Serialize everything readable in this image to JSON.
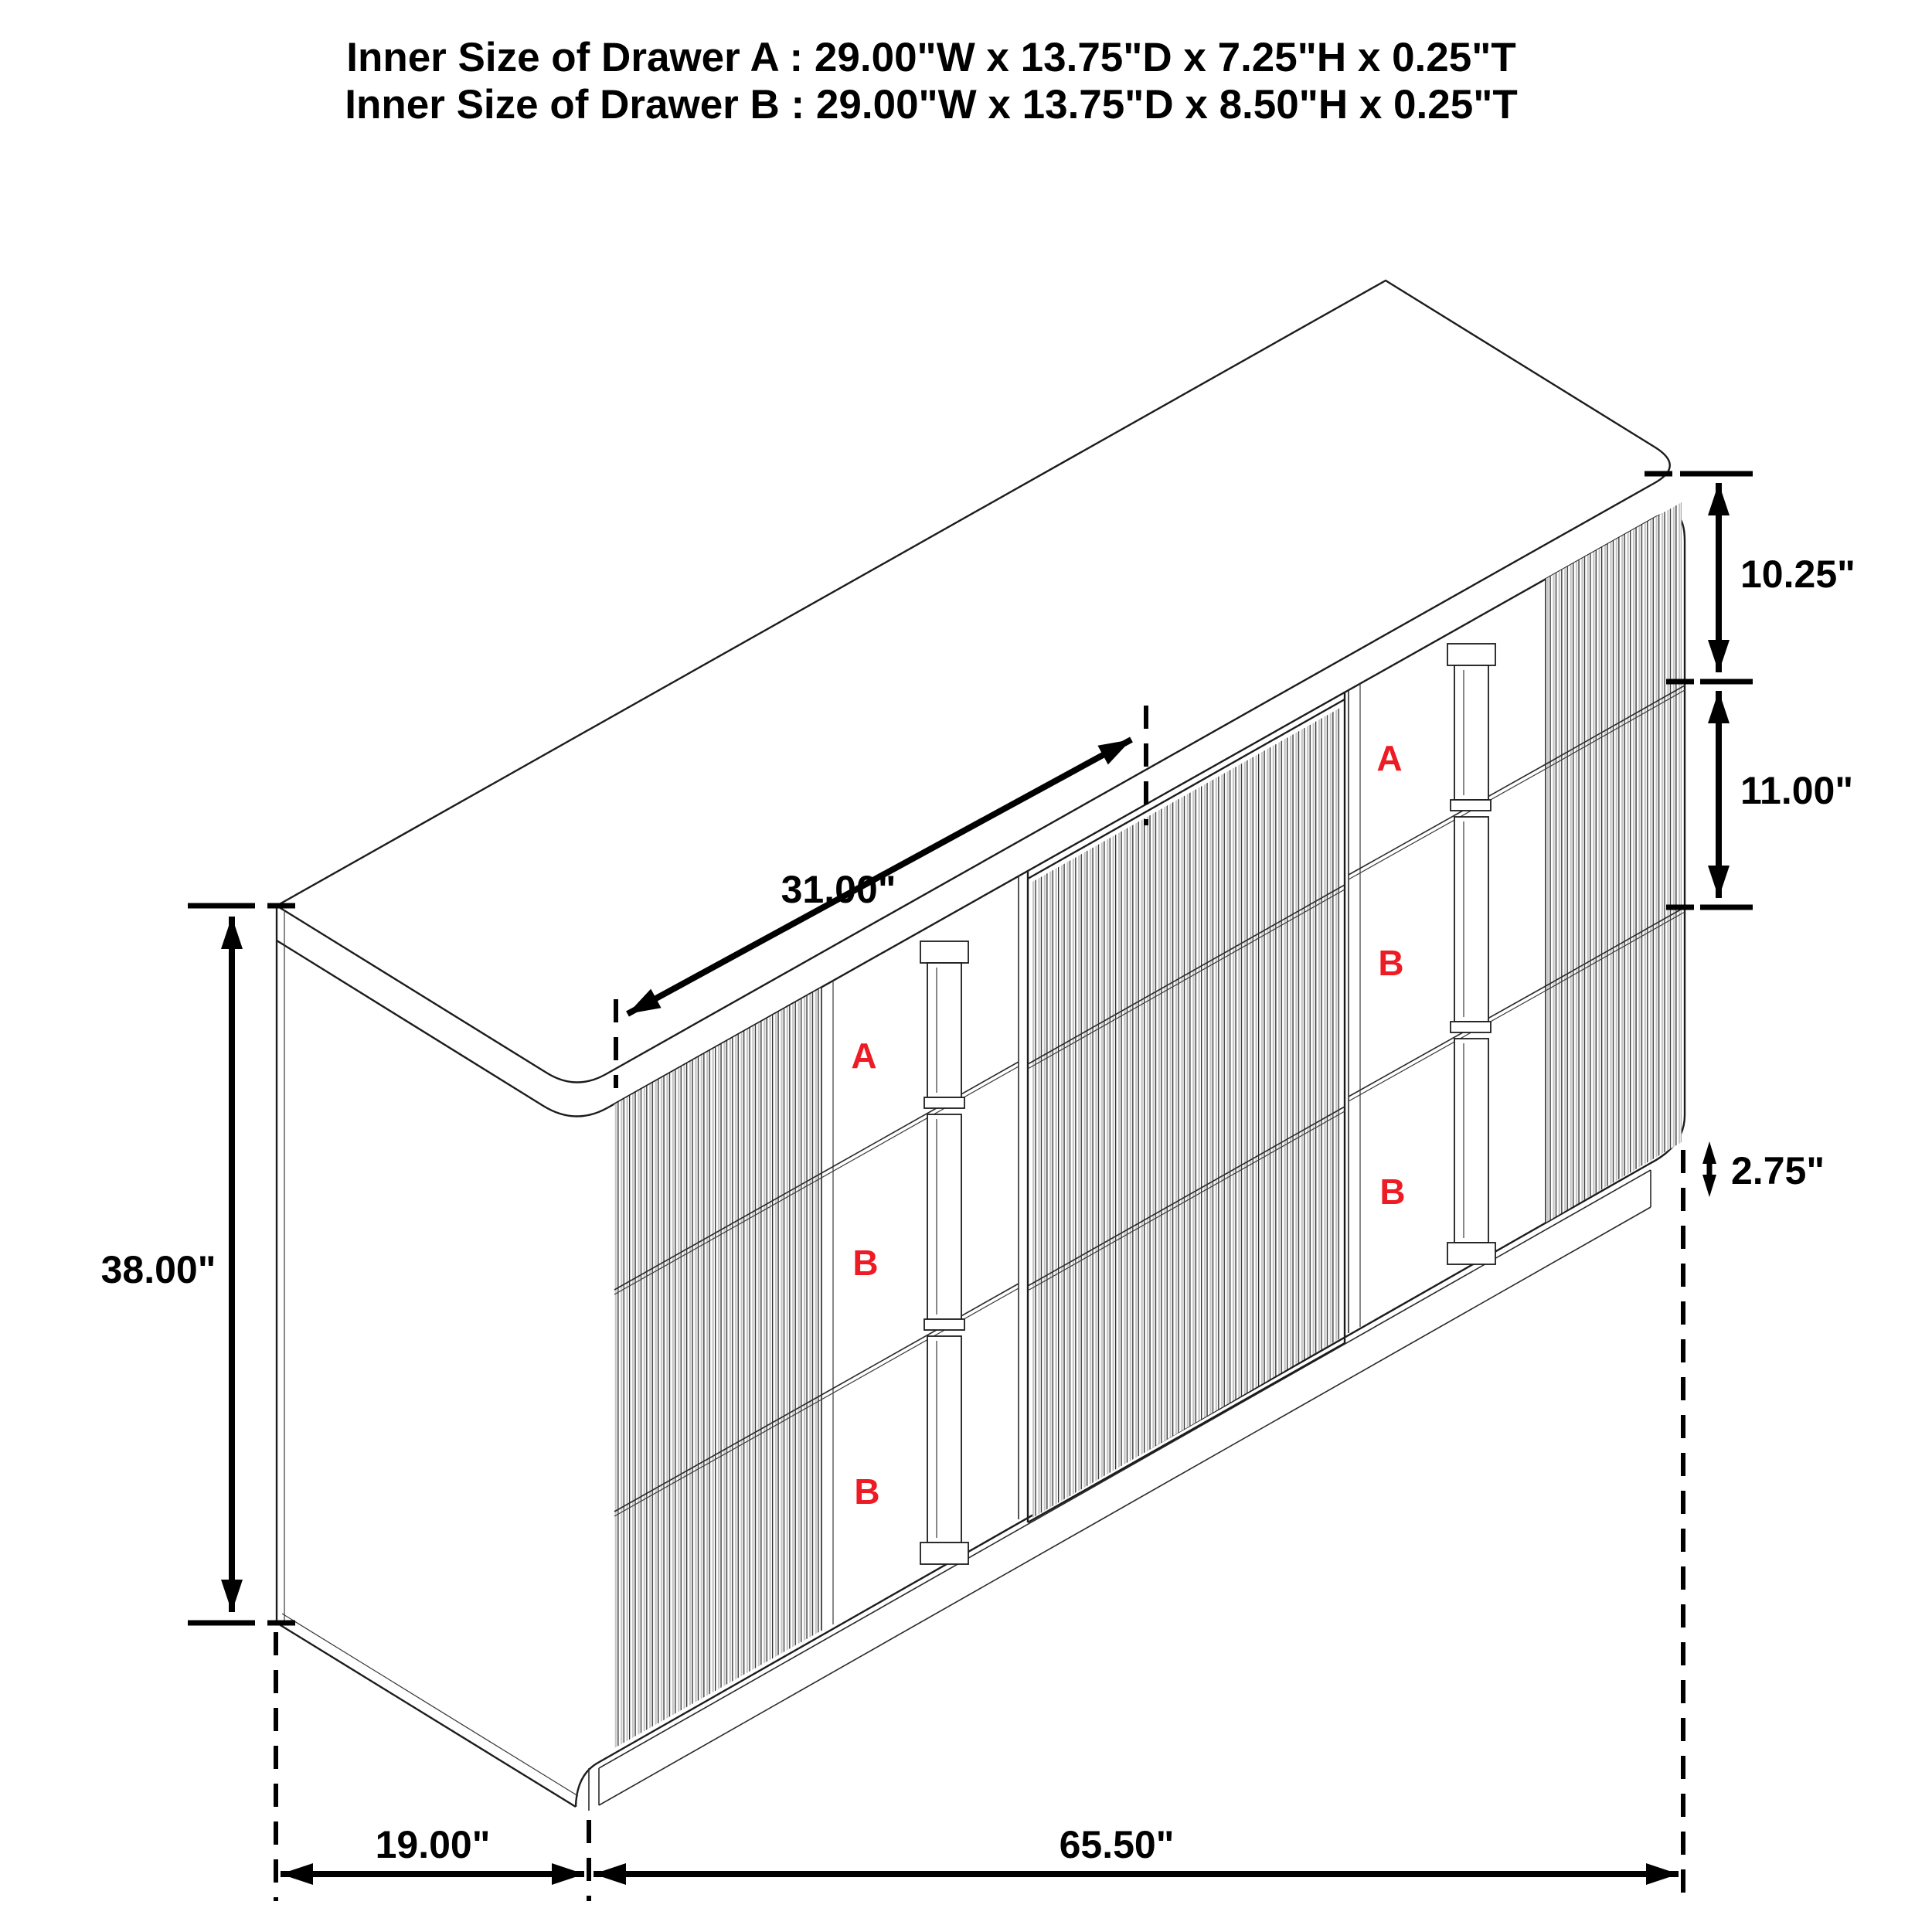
{
  "title": {
    "line1": "Inner Size of Drawer A : 29.00\"W x 13.75\"D x 7.25\"H x 0.25\"T",
    "line2": "Inner Size of Drawer B : 29.00\"W x 13.75\"D x 8.50\"H x 0.25\"T"
  },
  "dimensions": {
    "top_drawer_height": "10.25\"",
    "middle_drawer_height": "11.00\"",
    "toekick_height": "2.75\"",
    "overall_height": "38.00\"",
    "depth": "19.00\"",
    "overall_width": "65.50\"",
    "sliding_door_width": "31.00\""
  },
  "drawer_labels": {
    "left_bank": [
      "A",
      "B",
      "B"
    ],
    "right_bank": [
      "A",
      "B",
      "B"
    ]
  },
  "colors": {
    "label_red": "#ed1c24",
    "line_black": "#1c1c1c",
    "flute_gray": "#c6c6c6",
    "background": "#ffffff"
  }
}
